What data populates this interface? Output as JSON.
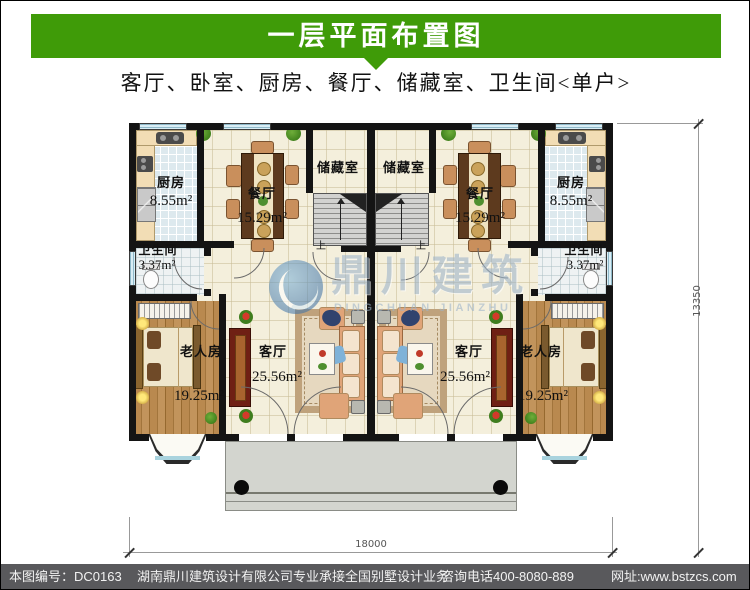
{
  "header": {
    "title": "一层平面布置图"
  },
  "subtitle": "客厅、卧室、厨房、餐厅、储藏室、卫生间<单户>",
  "plan": {
    "rooms": {
      "kitchen": {
        "name": "厨房",
        "area": "8.55m²"
      },
      "dining": {
        "name": "餐厅",
        "area": "15.29m²"
      },
      "storage": {
        "name": "储藏室"
      },
      "bathroom": {
        "name": "卫生间",
        "area": "3.37m²"
      },
      "living": {
        "name": "客厅",
        "area": "25.56m²"
      },
      "bedroom": {
        "name": "老人房",
        "area": "19.25m²"
      }
    },
    "stairs_up_label": "上",
    "dimensions": {
      "width_mm": "18000",
      "height_mm": "13350"
    },
    "watermark": {
      "name_cn": "鼎川建筑",
      "name_en": "DINGCHUAN JIANZHU"
    }
  },
  "footer": {
    "drawing_no_label": "本图编号：DC0163",
    "company_line": "湖南鼎川建筑设计有限公司专业承接全国别墅设计业务",
    "phone": "咨询电话400-8080-889",
    "website": "网址:www.bstzcs.com"
  },
  "colors": {
    "accent_green": "#3f9b08",
    "footer_bg": "#59595c",
    "wall_black": "#141414",
    "floor_cream": "#f4efdc",
    "floor_kitchen": "#dde9ee",
    "wood_brown": "#b9894f",
    "porch_gray": "#d3d5cf",
    "watermark_blue": "#9db4ca"
  }
}
